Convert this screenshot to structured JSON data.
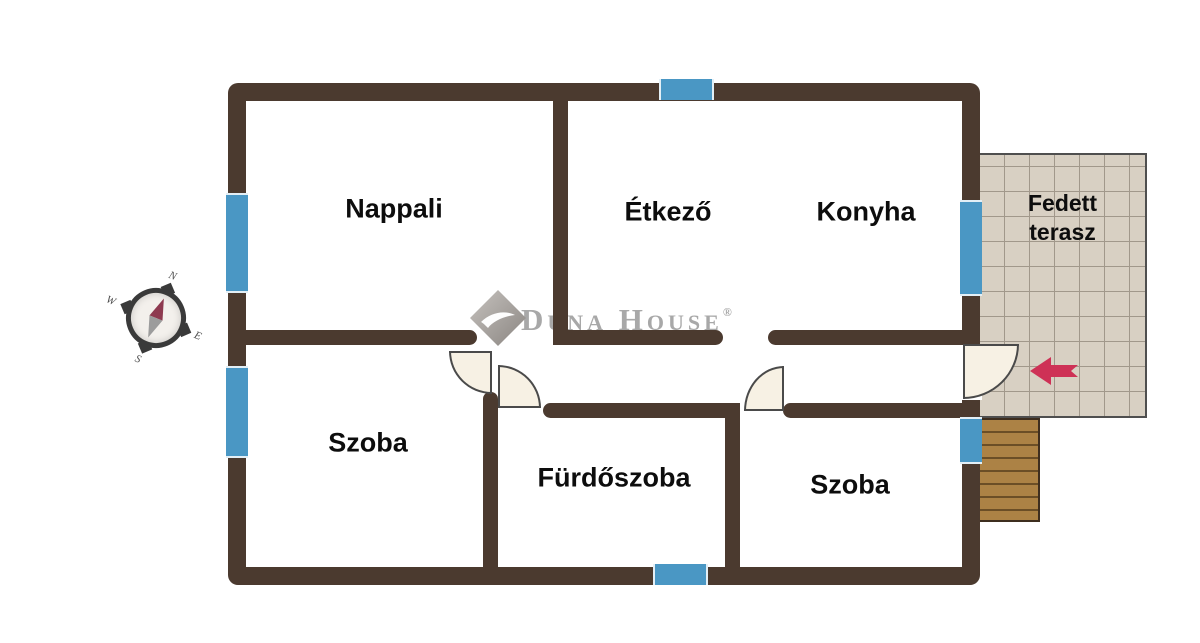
{
  "colors": {
    "wall": "#4b3a2f",
    "window": "#4a97c4",
    "door-fill": "#f7f1e4",
    "door-edge": "#4a4a4a",
    "terrace-fill": "#d8d0c3",
    "terrace-line": "#a1988b",
    "terrace-border": "#4f4f4f",
    "stairs-fill": "#ac8245",
    "stairs-line": "#6b4e26",
    "stairs-border": "#3e2e1f",
    "arrow": "#ce3156",
    "watermark": "#a8a8a8",
    "compass-ring": "#3a3a3a",
    "compass-needle-n": "#8e3a50",
    "compass-needle-s": "#9c9c9c",
    "label": "#0d0d0d"
  },
  "rooms": {
    "nappali": "Nappali",
    "etkezo": "Étkező",
    "konyha": "Konyha",
    "szoba_left": "Szoba",
    "furdoszoba": "Fürdőszoba",
    "szoba_right": "Szoba",
    "terasz_line1": "Fedett",
    "terasz_line2": "terasz"
  },
  "watermark": {
    "text": "Duna House",
    "registered": "®"
  },
  "compass": {
    "n": "N",
    "e": "E",
    "s": "S",
    "w": "W"
  }
}
